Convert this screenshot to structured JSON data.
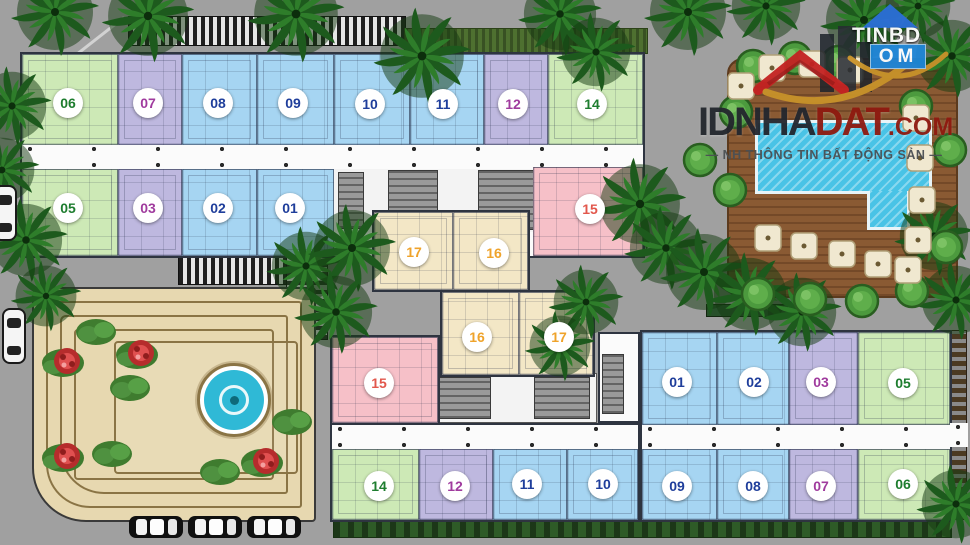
{
  "plan": {
    "kind": "apartment-site-plan"
  },
  "watermark": {
    "corner": {
      "top": "TINBD",
      "bottom": "OM"
    },
    "brand": {
      "dark": "IDNHA",
      "red": "DAT",
      "suffix": ".COM",
      "tagline": "— NH THÔNG TIN BẤT ĐỘNG SẢN —"
    }
  },
  "colors": {
    "road": "#a0a0a0",
    "plaza": "#e7d8b0",
    "deck": "#8a5a33",
    "water": "#49c3e6",
    "fountain": "#2fb9d6",
    "unit_green": "#cde9b6",
    "unit_blue": "#a6d5f2",
    "unit_purple": "#beb8df",
    "unit_pink": "#f6c0c8",
    "unit_tan": "#f3e7c6",
    "badge_green": "#1e7d2f",
    "badge_blue": "#1f3e9b",
    "badge_purple": "#a03b9e",
    "badge_red": "#e2574c",
    "badge_orange": "#efa32b"
  },
  "units": [
    {
      "label": "06",
      "color": "green",
      "x": 68,
      "y": 103
    },
    {
      "label": "07",
      "color": "purple",
      "x": 148,
      "y": 103
    },
    {
      "label": "08",
      "color": "blue",
      "x": 218,
      "y": 103
    },
    {
      "label": "09",
      "color": "blue",
      "x": 293,
      "y": 103
    },
    {
      "label": "10",
      "color": "blue",
      "x": 370,
      "y": 104
    },
    {
      "label": "11",
      "color": "blue",
      "x": 443,
      "y": 104
    },
    {
      "label": "12",
      "color": "purple",
      "x": 513,
      "y": 104
    },
    {
      "label": "14",
      "color": "green",
      "x": 592,
      "y": 104
    },
    {
      "label": "05",
      "color": "green",
      "x": 68,
      "y": 208
    },
    {
      "label": "03",
      "color": "purple",
      "x": 148,
      "y": 208
    },
    {
      "label": "02",
      "color": "blue",
      "x": 218,
      "y": 208
    },
    {
      "label": "01",
      "color": "blue",
      "x": 290,
      "y": 208
    },
    {
      "label": "15",
      "color": "red",
      "x": 590,
      "y": 209
    },
    {
      "label": "17",
      "color": "orange",
      "x": 414,
      "y": 252
    },
    {
      "label": "16",
      "color": "orange",
      "x": 494,
      "y": 253
    },
    {
      "label": "16",
      "color": "orange",
      "x": 477,
      "y": 337
    },
    {
      "label": "17",
      "color": "orange",
      "x": 559,
      "y": 337
    },
    {
      "label": "15",
      "color": "red",
      "x": 379,
      "y": 383
    },
    {
      "label": "01",
      "color": "blue",
      "x": 677,
      "y": 382
    },
    {
      "label": "02",
      "color": "blue",
      "x": 754,
      "y": 382
    },
    {
      "label": "03",
      "color": "purple",
      "x": 821,
      "y": 382
    },
    {
      "label": "05",
      "color": "green",
      "x": 903,
      "y": 383
    },
    {
      "label": "14",
      "color": "green",
      "x": 379,
      "y": 486
    },
    {
      "label": "12",
      "color": "purple",
      "x": 455,
      "y": 486
    },
    {
      "label": "11",
      "color": "blue",
      "x": 527,
      "y": 484
    },
    {
      "label": "10",
      "color": "blue",
      "x": 603,
      "y": 484
    },
    {
      "label": "09",
      "color": "blue",
      "x": 677,
      "y": 486
    },
    {
      "label": "08",
      "color": "blue",
      "x": 753,
      "y": 486
    },
    {
      "label": "07",
      "color": "purple",
      "x": 821,
      "y": 486
    },
    {
      "label": "06",
      "color": "green",
      "x": 903,
      "y": 484
    }
  ],
  "scenery": {
    "palms": [
      [
        55,
        12,
        1.0
      ],
      [
        148,
        16,
        1.05
      ],
      [
        296,
        14,
        1.1
      ],
      [
        422,
        56,
        1.1
      ],
      [
        560,
        14,
        0.95
      ],
      [
        596,
        52,
        0.9
      ],
      [
        688,
        12,
        1.0
      ],
      [
        766,
        6,
        0.9
      ],
      [
        864,
        20,
        1.0
      ],
      [
        918,
        6,
        0.85
      ],
      [
        952,
        56,
        0.95
      ],
      [
        12,
        106,
        0.9
      ],
      [
        2,
        170,
        0.85
      ],
      [
        26,
        240,
        0.95
      ],
      [
        46,
        296,
        0.8
      ],
      [
        306,
        266,
        0.9
      ],
      [
        352,
        248,
        1.0
      ],
      [
        336,
        312,
        0.95
      ],
      [
        640,
        204,
        1.05
      ],
      [
        666,
        248,
        0.95
      ],
      [
        704,
        272,
        1.0
      ],
      [
        750,
        294,
        0.95
      ],
      [
        802,
        312,
        0.9
      ],
      [
        586,
        302,
        0.85
      ],
      [
        560,
        346,
        0.8
      ],
      [
        934,
        236,
        0.9
      ],
      [
        956,
        300,
        0.9
      ],
      [
        956,
        504,
        0.9
      ]
    ],
    "round_trees": [
      [
        736,
        112
      ],
      [
        730,
        190
      ],
      [
        758,
        294
      ],
      [
        810,
        299
      ],
      [
        862,
        301
      ],
      [
        912,
        291
      ],
      [
        946,
        247
      ],
      [
        950,
        150
      ],
      [
        916,
        106
      ],
      [
        753,
        66
      ],
      [
        795,
        58
      ],
      [
        838,
        62
      ],
      [
        700,
        160
      ]
    ],
    "bushes": [
      [
        130,
        388
      ],
      [
        112,
        454
      ],
      [
        292,
        422
      ],
      [
        220,
        472
      ],
      [
        96,
        332
      ]
    ],
    "flowers": [
      [
        63,
        363
      ],
      [
        137,
        355
      ],
      [
        63,
        458
      ],
      [
        262,
        463
      ]
    ],
    "umbrellas": [
      [
        772,
        68
      ],
      [
        812,
        64
      ],
      [
        850,
        70
      ],
      [
        916,
        118
      ],
      [
        920,
        158
      ],
      [
        922,
        200
      ],
      [
        918,
        240
      ],
      [
        768,
        238
      ],
      [
        804,
        246
      ],
      [
        842,
        254
      ],
      [
        878,
        264
      ],
      [
        908,
        270
      ],
      [
        741,
        86
      ]
    ],
    "cars_h": [
      [
        156,
        527
      ],
      [
        215,
        527
      ],
      [
        274,
        527
      ]
    ],
    "cars_v": [
      [
        14,
        336
      ],
      [
        5,
        213
      ]
    ]
  }
}
